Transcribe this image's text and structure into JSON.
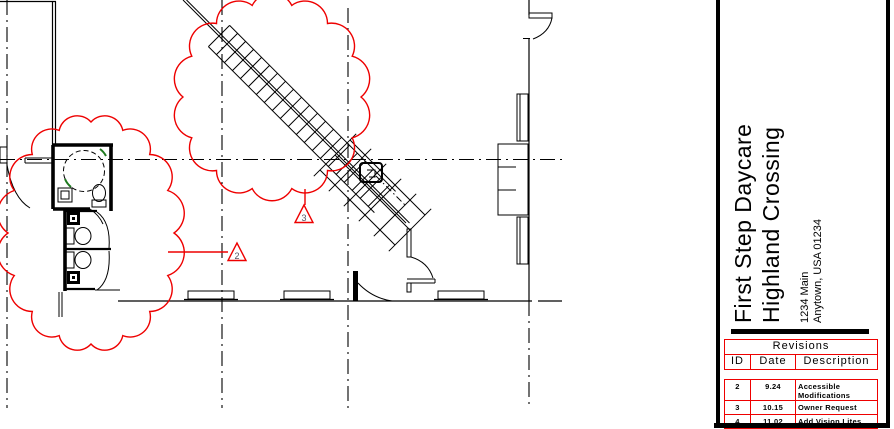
{
  "colors": {
    "revision_red": "#ee0000",
    "marker_green": "#1f7a1f",
    "line_black": "#000000"
  },
  "drawing": {
    "description": "Floor plan with revision clouds around accessible restrooms and sloped entry ramp",
    "revision_tags": [
      {
        "number": "2"
      },
      {
        "number": "3"
      }
    ]
  },
  "title_block": {
    "project_name_line1": "First Step Daycare",
    "project_name_line2": "Highland Crossing",
    "address_line1": "1234 Main",
    "address_line2": "Anytown, USA 01234",
    "revisions": {
      "title": "Revisions",
      "columns": [
        "ID",
        "Date",
        "Description"
      ],
      "rows": [
        {
          "id": "2",
          "date": "9.24",
          "description": "Accessible Modifications"
        },
        {
          "id": "3",
          "date": "10.15",
          "description": "Owner Request"
        },
        {
          "id": "4",
          "date": "11.02",
          "description": "Add Vision Lites"
        }
      ]
    }
  }
}
